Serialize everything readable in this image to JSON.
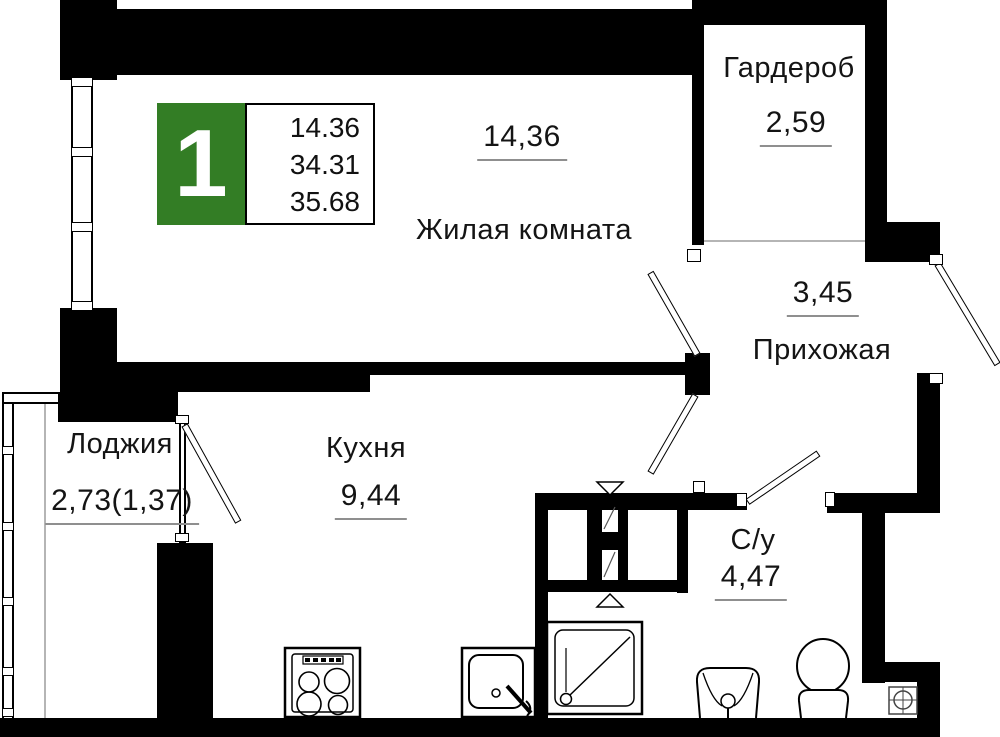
{
  "plan": {
    "title": "apartment-floor-plan",
    "unit_badge": {
      "rooms_count": "1",
      "area_living": "14.36",
      "area_no_loggia": "34.31",
      "area_total": "35.68",
      "accent_color": "#337d25"
    },
    "rooms": [
      {
        "id": "living",
        "name": "Жилая комната",
        "area": "14,36"
      },
      {
        "id": "wardrobe",
        "name": "Гардероб",
        "area": "2,59"
      },
      {
        "id": "hallway",
        "name": "Прихожая",
        "area": "3,45"
      },
      {
        "id": "kitchen",
        "name": "Кухня",
        "area": "9,44"
      },
      {
        "id": "loggia",
        "name": "Лоджия",
        "area": "2,73(1,37)"
      },
      {
        "id": "bathroom",
        "name": "С/у",
        "area": "4,47"
      }
    ],
    "icons": [
      "stove-icon",
      "kitchen-sink-icon",
      "shower-icon",
      "washbasin-icon",
      "toilet-icon",
      "drain-symbol-icon",
      "vent-marker-down-icon",
      "vent-marker-up-icon"
    ],
    "colors": {
      "wall": "#000000",
      "underline": "#8f8f8f",
      "text": "#141414"
    }
  }
}
